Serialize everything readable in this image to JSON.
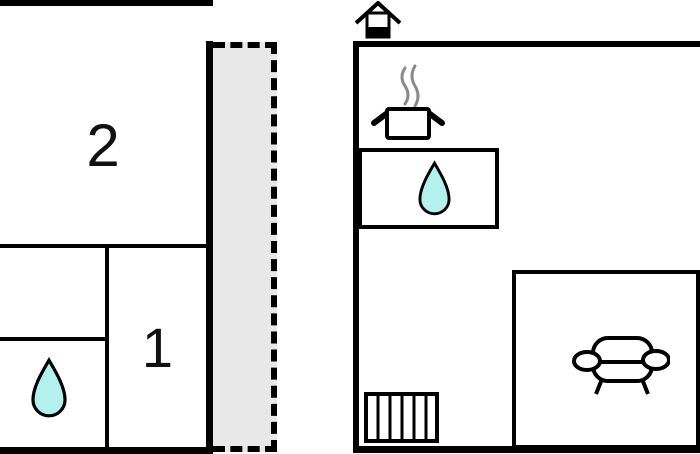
{
  "diagram_type": "floor-plan",
  "colors": {
    "wall": "#000000",
    "background": "#ffffff",
    "terrace_fill": "#e8e8e8",
    "water_drop_fill": "#b4f1ee",
    "steam": "#8a8a8a"
  },
  "units": {
    "left": {
      "name": "left-unit-floor",
      "room_2_label": "2",
      "room_1_label": "1",
      "bathroom_icon": "water-drop-icon",
      "terrace_area": "dashed-grey-terrace"
    },
    "right": {
      "name": "right-unit-floor",
      "chimney_icon": "chimney-icon",
      "steam_icon": "steam-icon",
      "cooking_pot_icon": "cooking-pot-icon",
      "sink_icon": "water-drop-icon",
      "sofa_icon": "sofa-icon",
      "stairs_icon": "stairs-icon"
    }
  }
}
